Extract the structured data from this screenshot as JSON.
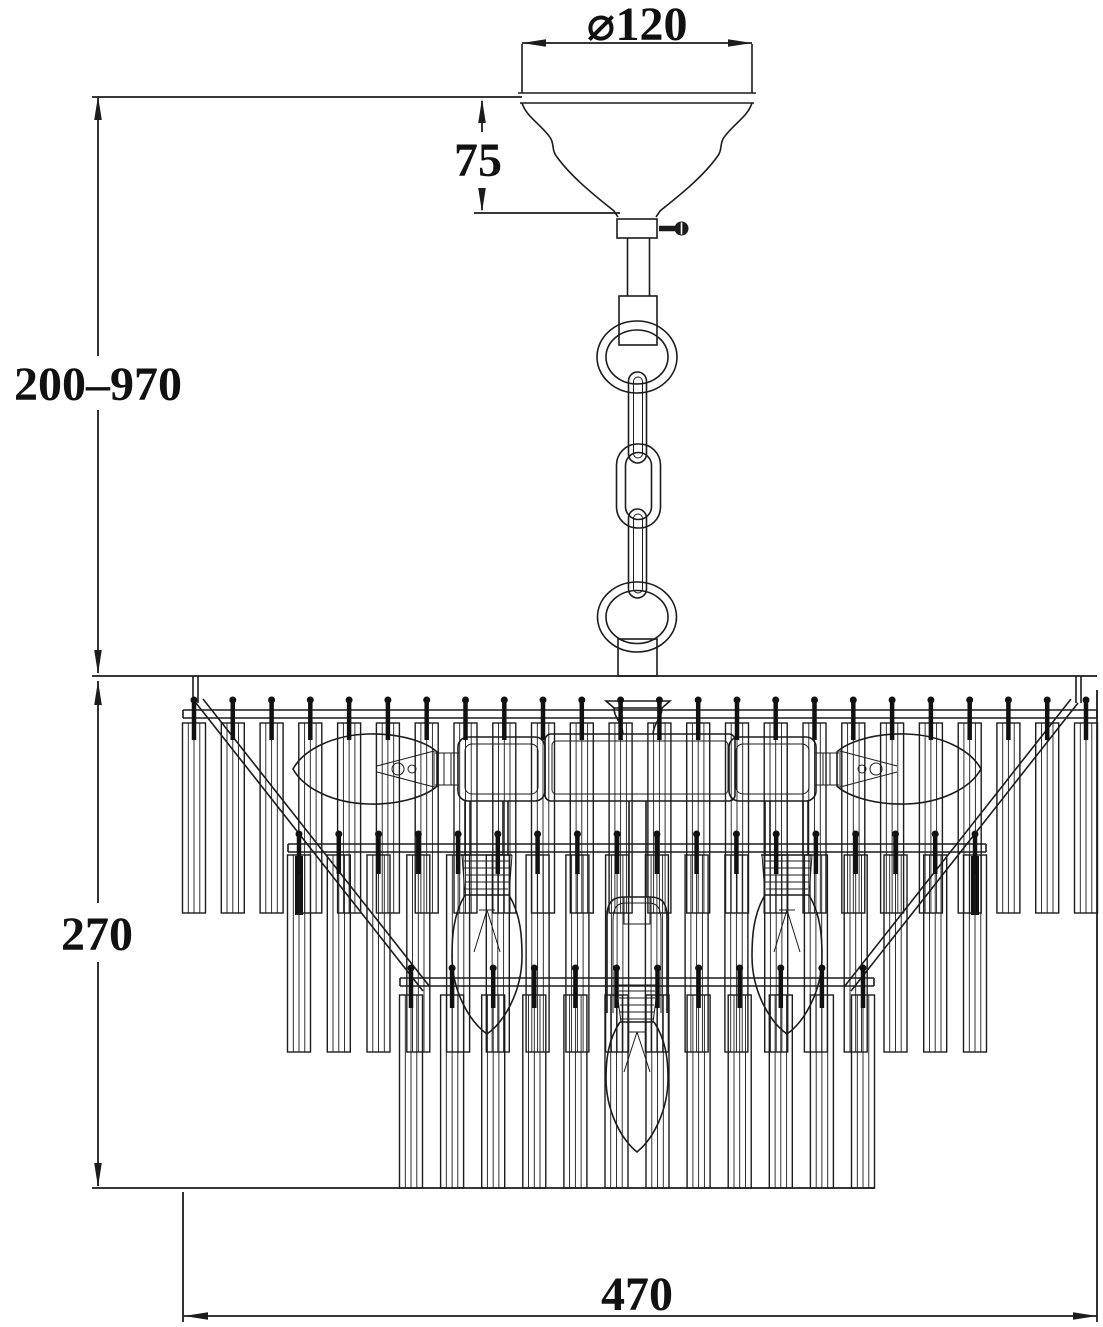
{
  "diagram": {
    "type": "technical-line-drawing",
    "subject": "ceiling chandelier with chain suspension and cascading glass rods",
    "dimensions": {
      "canopy_diameter": "⌀120",
      "canopy_height": "75",
      "suspension_height_range": "200–970",
      "body_height": "270",
      "body_diameter": "470"
    },
    "parts": {
      "canopy": "ceiling canopy cup",
      "chain": "adjustable chain with rings and links",
      "body": "three-tier glass rod shade",
      "bulbs_shown": 5,
      "bulb_type": "candle bulbs"
    },
    "colors": {
      "line": "#1c1c1c",
      "background": "#ffffff"
    }
  }
}
